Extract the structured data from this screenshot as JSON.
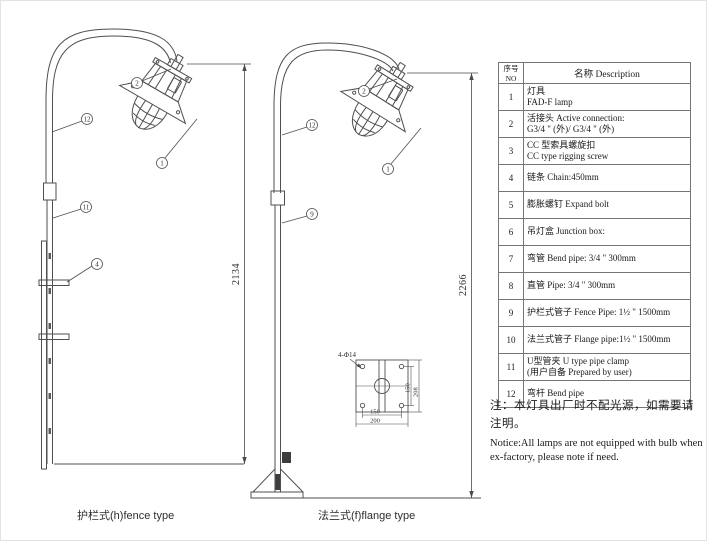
{
  "drawings": {
    "fence": {
      "caption": "护栏式(h)fence type",
      "dimension": "2134",
      "callouts": [
        "2",
        "12",
        "1",
        "11",
        "4"
      ]
    },
    "flange": {
      "caption": "法兰式(f)flange type",
      "dimension": "2266",
      "callouts": [
        "2",
        "12",
        "1",
        "9"
      ],
      "base_detail": {
        "hole_label": "4-Φ14",
        "hole_spacing_w": "150",
        "plate_width": "200",
        "hole_spacing_h": "150",
        "plate_height": "208"
      }
    }
  },
  "table": {
    "header": {
      "no": "序号NO",
      "desc": "名称  Description"
    },
    "rows": [
      {
        "no": "1",
        "line1": "灯具",
        "line2": "FAD-F lamp"
      },
      {
        "no": "2",
        "line1": "活接头  Active connection:",
        "line2": "G3/4 \" (外)/ G3/4 \" (外)"
      },
      {
        "no": "3",
        "line1": "CC 型索具螺旋扣",
        "line2": "CC type rigging screw"
      },
      {
        "no": "4",
        "line1": "链条  Chain:450mm",
        "line2": ""
      },
      {
        "no": "5",
        "line1": "膨胀螺钉  Expand bolt",
        "line2": ""
      },
      {
        "no": "6",
        "line1": "吊灯盒  Junction box:",
        "line2": ""
      },
      {
        "no": "7",
        "line1": "弯管  Bend pipe: 3/4 \"  300mm",
        "line2": ""
      },
      {
        "no": "8",
        "line1": "直管  Pipe: 3/4 \"  300mm",
        "line2": ""
      },
      {
        "no": "9",
        "line1": "护栏式管子 Fence Pipe: 1½ \" 1500mm",
        "line2": ""
      },
      {
        "no": "10",
        "line1": "法兰式管子 Flange pipe:1½ \" 1500mm",
        "line2": ""
      },
      {
        "no": "11",
        "line1": "U型管夹  U type pipe clamp",
        "line2": "(用户自备 Prepared by user)"
      },
      {
        "no": "12",
        "line1": "弯杆  Bend pipe",
        "line2": ""
      }
    ]
  },
  "notes": {
    "cn": "注：本灯具出厂时不配光源，如需要请注明。",
    "en": "Notice:All lamps are not equipped with bulb when ex-factory, please note if need."
  },
  "colors": {
    "line": "#4f4f4f",
    "text": "#1a1a1a",
    "table_border": "#757575"
  }
}
